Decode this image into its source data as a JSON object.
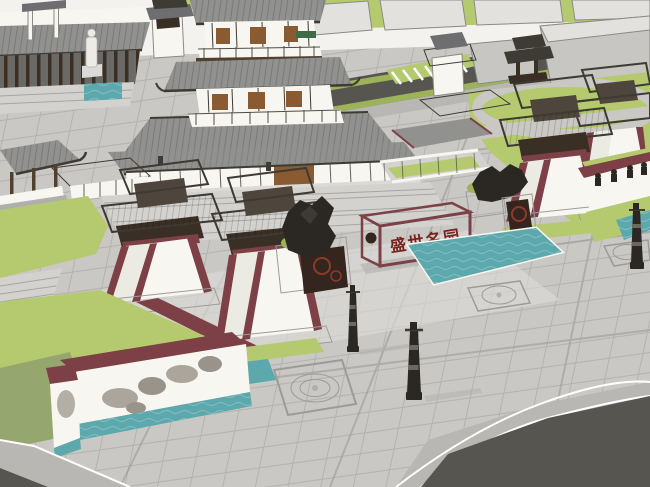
{
  "scene": {
    "type": "3d-architectural-render",
    "subject": "SketchUp-style shaded render of a Tang-dynasty Chinese temple complex: central multi-tier pagoda hall, que gate towers with tapered white bodies and maroon trim, stone plaza with paving medallions, reflecting pools, mural walls, bronze sculptures, lamp posts, lawns and a surrounding modern city massing with road",
    "view": "aerial three-quarter perspective from south-west"
  },
  "sign": {
    "characters": "盛世名园",
    "legible": false
  },
  "palette": {
    "sky": "#f3f2ef",
    "blocktop": "#e2e1de",
    "blockside": "#c7c6c3",
    "blockedge": "#8b8a87",
    "road": "#57554f",
    "roadside": "#b8b7b4",
    "lawn": "#b5c96f",
    "lawndk": "#9cb35a",
    "shadow": "#8fa06f",
    "plaza": "#c9c8c5",
    "plazalt": "#dbdad7",
    "plazadk": "#b0afac",
    "grout": "#9c9b98",
    "steps": "#d3d2cf",
    "stepline": "#a7a6a3",
    "water": "#5ca8ad",
    "waterlight": "#8cc4c8",
    "maroon": "#7c4046",
    "maroondk": "#5e3138",
    "roof": "#919190",
    "roofdk": "#6e6e70",
    "eave": "#3e3a34",
    "timber": "#52402e",
    "timberdk": "#3a2f24",
    "wall": "#f8f6f1",
    "door": "#8a5a31",
    "bronze": "#2b2824",
    "relief": "#34251e",
    "reliefred": "#8c3a2e",
    "signred": "#7b221e",
    "mural": "#a39d93",
    "plaque": "#3f6b49"
  }
}
